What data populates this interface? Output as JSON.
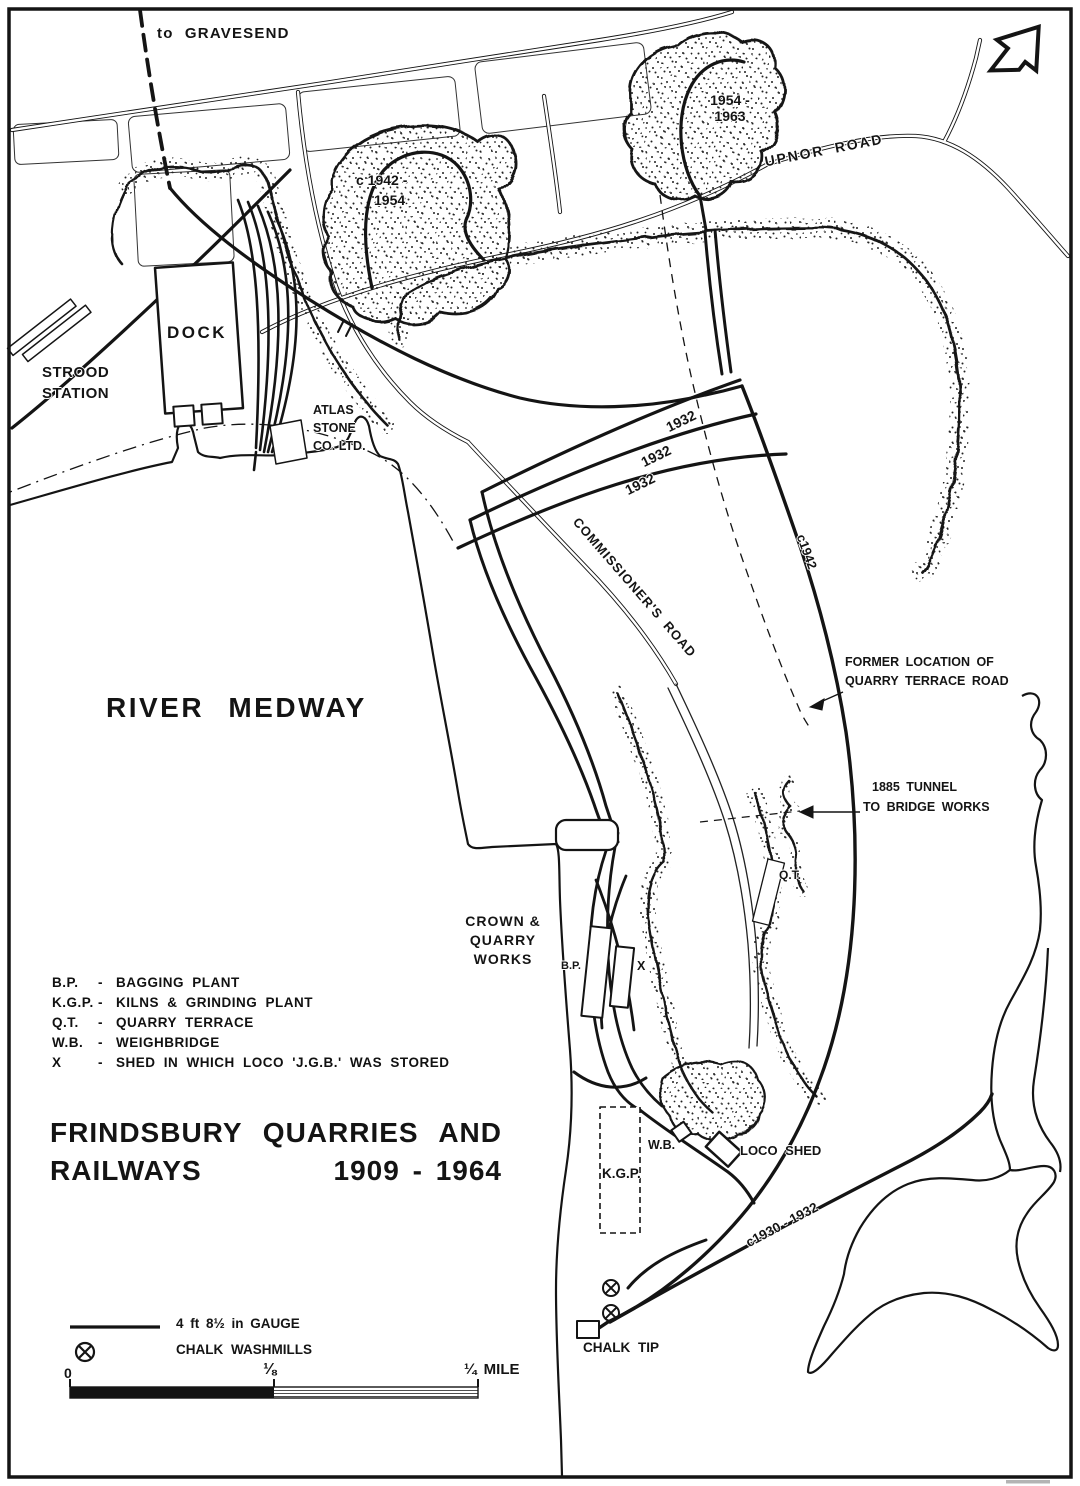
{
  "map": {
    "title": {
      "line1": "FRINDSBURY QUARRIES AND",
      "line2_left": "RAILWAYS",
      "line2_right": "1909 - 1964"
    },
    "labels": {
      "to_gravesend": "to GRAVESEND",
      "quarry_1954_1963_line1": "1954 -",
      "quarry_1954_1963_line2": "1963",
      "upnor_road": "UPNOR ROAD",
      "quarry_1942_1954_line1": "c 1942 -",
      "quarry_1942_1954_line2": "1954",
      "dock": "DOCK",
      "strood_station_line1": "STROOD",
      "strood_station_line2": "STATION",
      "atlas_line1": "ATLAS",
      "atlas_line2": "STONE",
      "atlas_line3": "CO. LTD.",
      "y1932_1": "1932",
      "y1932_2": "1932",
      "y1932_3": "1932",
      "c1942": "c1942",
      "commissioners_road": "COMMISSIONER'S ROAD",
      "river_medway": "RIVER MEDWAY",
      "former_location_line1": "FORMER LOCATION OF",
      "former_location_line2": "QUARRY TERRACE ROAD",
      "tunnel_line1": "1885 TUNNEL",
      "tunnel_line2": "TO BRIDGE WORKS",
      "qt": "Q.T.",
      "crown_line1": "CROWN &",
      "crown_line2": "QUARRY",
      "crown_line3": "WORKS",
      "bp": "B.P.",
      "x_shed": "X",
      "wb": "W.B.",
      "loco_shed": "LOCO SHED",
      "kgp": "K.G.P.",
      "c1930_1932": "c1930 - 1932",
      "chalk_tip": "CHALK TIP"
    },
    "abbreviations": [
      {
        "abbr": "B.P.",
        "sep": "-",
        "desc": "BAGGING PLANT"
      },
      {
        "abbr": "K.G.P.",
        "sep": "-",
        "desc": "KILNS & GRINDING PLANT"
      },
      {
        "abbr": "Q.T.",
        "sep": "-",
        "desc": "QUARRY TERRACE"
      },
      {
        "abbr": "W.B.",
        "sep": "-",
        "desc": "WEIGHBRIDGE"
      },
      {
        "abbr": "X",
        "sep": "-",
        "desc": "SHED IN WHICH LOCO 'J.G.B.' WAS STORED"
      }
    ],
    "key": {
      "gauge_label": "4 ft 8½ in GAUGE",
      "washmills_label": "CHALK WASHMILLS"
    },
    "scale": {
      "tick_start": "0",
      "tick_mid": "⅛",
      "tick_end": "¼ MILE"
    },
    "colors": {
      "ink": "#141414",
      "paper": "#ffffff"
    }
  }
}
